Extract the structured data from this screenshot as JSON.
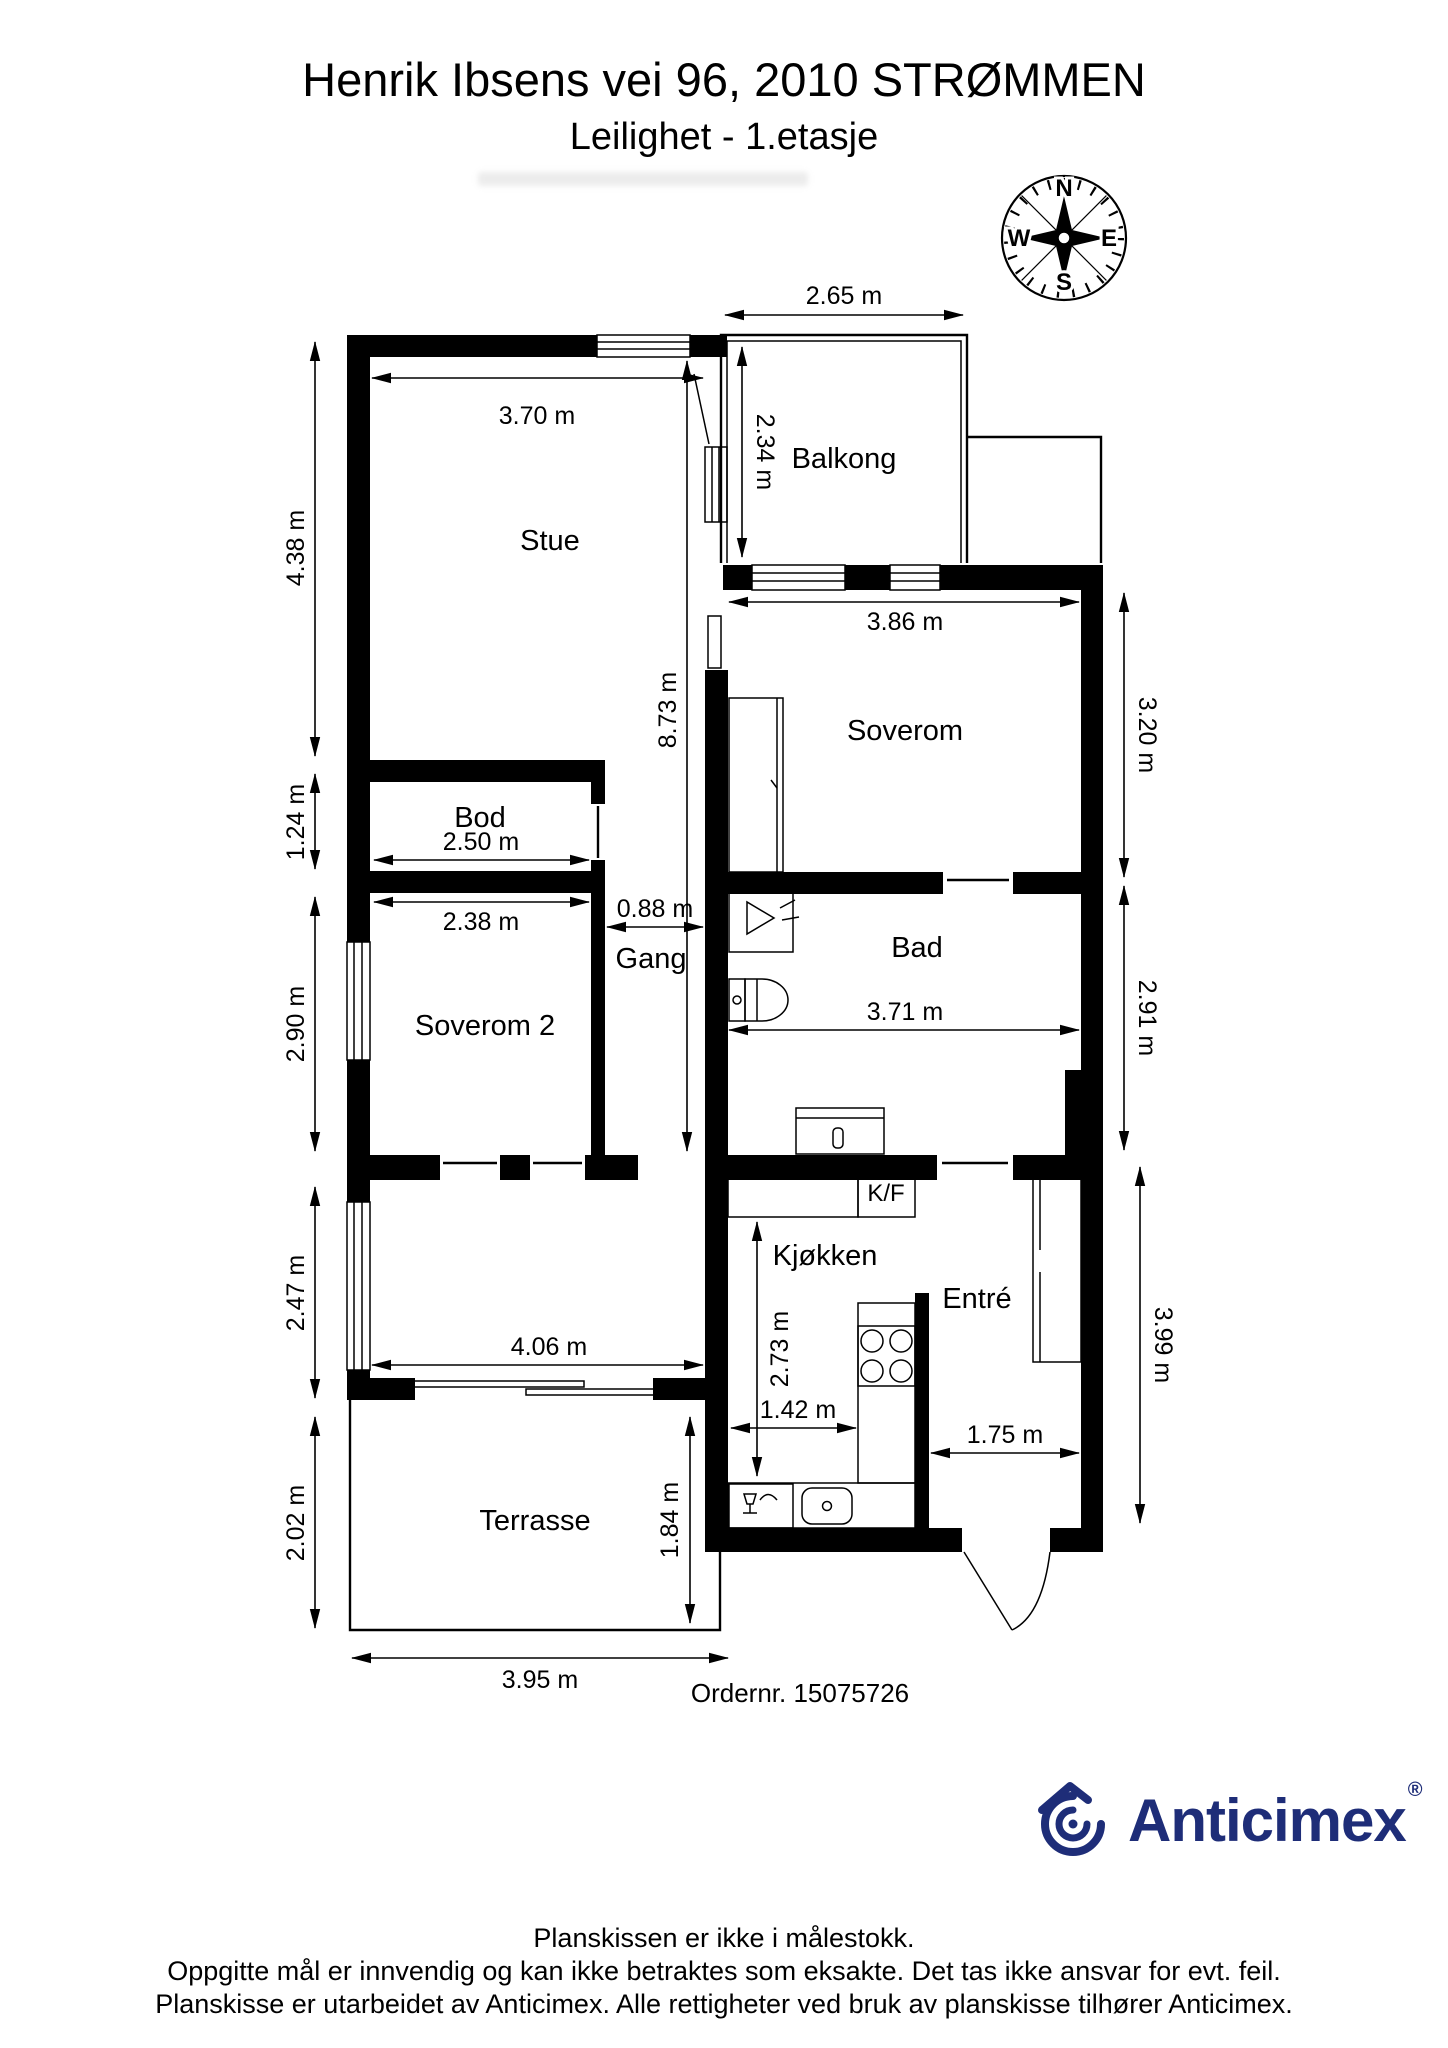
{
  "header": {
    "title": "Henrik Ibsens vei 96, 2010 STRØMMEN",
    "subtitle": "Leilighet  - 1.etasje"
  },
  "compass": {
    "north": "N",
    "east": "E",
    "south": "S",
    "west": "W"
  },
  "rooms": {
    "balkong": "Balkong",
    "stue": "Stue",
    "soverom": "Soverom",
    "bod": "Bod",
    "gang": "Gang",
    "bad": "Bad",
    "soverom2": "Soverom 2",
    "kf": "K/F",
    "kjokken": "Kjøkken",
    "entre": "Entré",
    "terrasse": "Terrasse"
  },
  "measurements": {
    "balkong_width": "2.65 m",
    "balkong_depth": "2.34 m",
    "stue_width": "3.70 m",
    "stue_height": "4.38 m",
    "soverom_width": "3.86 m",
    "soverom_height": "3.20 m",
    "corridor_length": "8.73 m",
    "bod_height": "1.24 m",
    "bod_width": "2.50 m",
    "soverom2_width": "2.38 m",
    "soverom2_height": "2.90 m",
    "gang_width": "0.88 m",
    "bad_width": "3.71 m",
    "bad_height": "2.91 m",
    "stue2_height": "2.47 m",
    "stue2_width": "4.06 m",
    "kjokken_height": "2.73 m",
    "kjokken_width": "1.42 m",
    "entre_width": "1.75 m",
    "entre_height": "3.99 m",
    "terrasse_height": "2.02 m",
    "terrasse_door_height": "1.84 m",
    "terrasse_width": "3.95 m"
  },
  "order": {
    "label": "Ordernr. 15075726"
  },
  "branding": {
    "name": "Anticimex",
    "registered": "®"
  },
  "disclaimer": [
    "Planskissen er ikke i målestokk.",
    "Oppgitte mål er innvendig og kan ikke betraktes som eksakte. Det tas ikke ansvar for evt. feil.",
    "Planskisse er utarbeidet av Anticimex. Alle rettigheter ved bruk av planskisse tilhører Anticimex."
  ],
  "colors": {
    "wall": "#000000",
    "logo_blue": "#1e2d78",
    "background": "#ffffff"
  }
}
